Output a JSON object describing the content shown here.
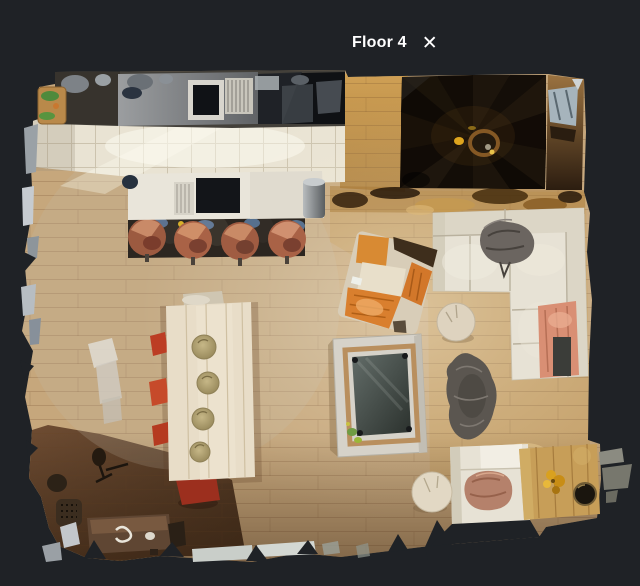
{
  "header": {
    "title": "Floor 4",
    "close_icon": "✕"
  },
  "floorplan": {
    "floor_name": "Floor 4",
    "view_type": "top-down dollhouse scan of an open-plan floor",
    "rooms": [
      "kitchen",
      "dining area",
      "living room",
      "spiral staircase"
    ],
    "features": [
      "kitchen counter with sink and appliances",
      "kitchen island with four copper bar stools",
      "tiled kitchen floor strip",
      "spiral staircase",
      "L-shaped cream sectional sofa with gray fur throw and salmon blanket",
      "orange armchair",
      "square glass fire table",
      "gray sheepskin rug",
      "pale wood dining table with four place settings and red chairs",
      "dark wood sideboard bench",
      "round tree-stump side tables",
      "wooden side table with bowl"
    ]
  },
  "colors": {
    "background": "#1f2226",
    "header_text": "#ffffff",
    "wood_floor": "#c6a77c",
    "tile_floor": "#e9e3d3",
    "golden_wood": "#c0914a",
    "sofa_cream": "#e7e2d5",
    "accent_orange": "#d97f2e",
    "chair_red": "#c0402a",
    "copper_stool": "#ad6a4c",
    "salmon_blanket": "#d98f74",
    "staircase_dark": "#16100a"
  }
}
